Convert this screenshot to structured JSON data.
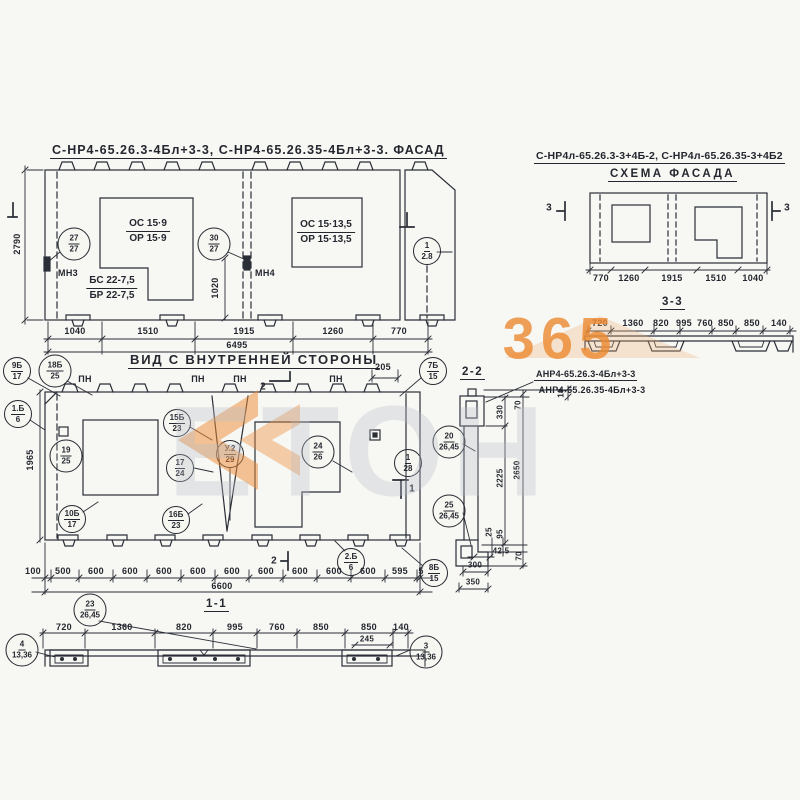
{
  "watermark": {
    "number": "365",
    "letters": "ЕТОН",
    "orange": "#ed8a31",
    "gray": "#b9bec9"
  },
  "facade": {
    "title": "С-НР4-65.26.3-4Бл+3-3, С-НР4-65.26.35-4Бл+3-3. ФАСАД",
    "height": "2790",
    "mid": "1020",
    "win1_top": "ОС 15·9",
    "win1_bot": "ОР 15·9",
    "win2_top": "ОС 15·13,5",
    "win2_bot": "ОР 15·13,5",
    "beam_top": "БС 22-7,5",
    "beam_bot": "БР 22-7,5",
    "mn3": "МН3",
    "mn4": "МН4",
    "c27": {
      "t": "27",
      "b": "27"
    },
    "c30": {
      "t": "30",
      "b": "27"
    },
    "c1": {
      "t": "1",
      "b": "2.8"
    },
    "dims": [
      "1040",
      "1510",
      "1915",
      "1260",
      "770"
    ],
    "total": "6495"
  },
  "scheme": {
    "title": "С-НР4л-65.26.3-3+4Б-2, С-НР4л-65.26.35-3+4Б2",
    "subtitle": "СХЕМА ФАСАДА",
    "sec": "3",
    "dims": [
      "770",
      "1260",
      "1915",
      "1510",
      "1040"
    ]
  },
  "s33": {
    "title": "3-3",
    "dims": [
      "720",
      "1360",
      "820",
      "995",
      "760",
      "850",
      "850",
      "140"
    ]
  },
  "inner": {
    "title": "ВИД С ВНУТРЕННЕЙ СТОРОНЫ",
    "pn": "ПН",
    "d205": "205",
    "height": "1965",
    "sec2": "2",
    "sec1": "1",
    "c9": {
      "t": "9Б",
      "b": "17"
    },
    "c18": {
      "t": "18Б",
      "b": "25"
    },
    "c1b": {
      "t": "1.Б",
      "b": "6"
    },
    "c7": {
      "t": "7Б",
      "b": "15"
    },
    "c19": {
      "t": "19",
      "b": "25"
    },
    "c15": {
      "t": "15Б",
      "b": "23"
    },
    "cy2": {
      "t": "У.2",
      "b": "29"
    },
    "c17": {
      "t": "17",
      "b": "24"
    },
    "c24": {
      "t": "24",
      "b": "26"
    },
    "c10": {
      "t": "10Б",
      "b": "17"
    },
    "c16": {
      "t": "16Б",
      "b": "23"
    },
    "c128": {
      "t": "1",
      "b": "28"
    },
    "c2b": {
      "t": "2.Б",
      "b": "6"
    },
    "c8": {
      "t": "8Б",
      "b": "15"
    },
    "dims": [
      "100",
      "500",
      "600",
      "600",
      "600",
      "600",
      "600",
      "600",
      "600",
      "600",
      "600",
      "595",
      "5"
    ],
    "total": "6600"
  },
  "s22": {
    "title": "2-2",
    "label1": "АНР4-65.26.3-4Бл+3-3",
    "label2": "АНР4-65.26.35-4Бл+3-3",
    "c20": {
      "t": "20",
      "b": "26,45"
    },
    "c25": {
      "t": "25",
      "b": "26,45"
    },
    "d330": "330",
    "d70": "70",
    "d10": "10",
    "d2225": "2225",
    "d2650": "2650",
    "d25": "25",
    "d95": "95",
    "d425": "42.5",
    "d70b": "70",
    "d300": "300",
    "d350": "350"
  },
  "s11": {
    "title": "1-1",
    "c23": {
      "t": "23",
      "b": "26,45"
    },
    "c4": {
      "t": "4",
      "b": "13,36"
    },
    "c3": {
      "t": "3",
      "b": "13,36"
    },
    "dims": [
      "720",
      "1360",
      "820",
      "995",
      "760",
      "850",
      "850",
      "140"
    ],
    "d245": "245"
  }
}
